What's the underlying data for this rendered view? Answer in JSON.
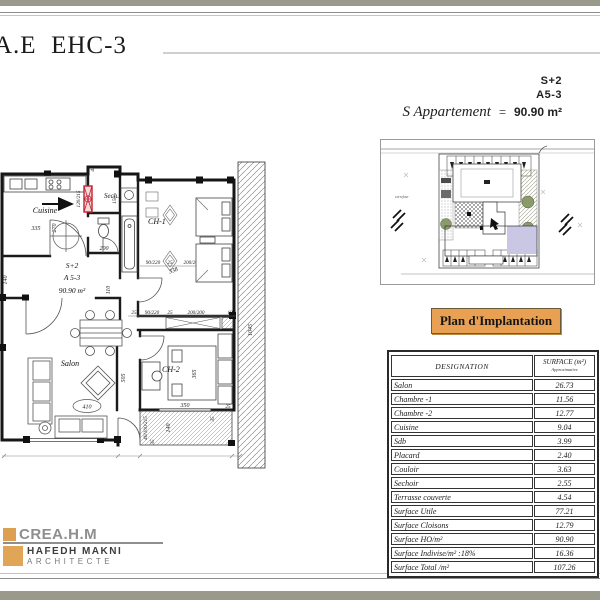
{
  "page": {
    "title": "A.E  EHC-3"
  },
  "unit": {
    "type": "S+2",
    "code": "A5-3",
    "label": "S  Appartement",
    "equals": "=",
    "area": "90.90 m²"
  },
  "siteplan": {
    "road_label": "carrefour"
  },
  "banner": {
    "text": "Plan d'Implantation"
  },
  "table": {
    "header": {
      "designation": "DESIGNATION",
      "surface": "SURFACE (m²)",
      "surface_sub": "Approximative"
    },
    "rows": [
      {
        "label": "Salon",
        "value": "26.73"
      },
      {
        "label": "Chambre -1",
        "value": "11.56"
      },
      {
        "label": "Chambre -2",
        "value": "12.77"
      },
      {
        "label": "Cuisine",
        "value": "9.04"
      },
      {
        "label": "Sdb",
        "value": "3.99"
      },
      {
        "label": "Placard",
        "value": "2.40"
      },
      {
        "label": "Couloir",
        "value": "3.63"
      },
      {
        "label": "Sechoir",
        "value": "2.55"
      },
      {
        "label": "Terrasse couverte",
        "value": "4.54"
      },
      {
        "label": "Surface Utile",
        "value": "77.21"
      },
      {
        "label": "Surface Cloisons",
        "value": "12.79"
      },
      {
        "label": "Surface HO/m²",
        "value": "90.90"
      },
      {
        "label": "Surface Indivise/m² :18%",
        "value": "16.36"
      },
      {
        "label": "Surface Total /m²",
        "value": "107.26"
      }
    ]
  },
  "logo": {
    "brand": "CREA.H.M",
    "name": "HAFEDH MAKNI",
    "title": "ARCHITECTE"
  },
  "plan": {
    "rooms": {
      "cuisine": "Cuisine",
      "sech": "Sech.",
      "ch1": "CH-1",
      "ch2": "CH-2",
      "salon": "Salon"
    },
    "unit": {
      "line1": "S+2",
      "line2": "A 5-3",
      "line3": "90.90 m²"
    },
    "dims": {
      "d45": "45",
      "d150": "150",
      "d120_215": "120/215",
      "d335": "335",
      "d270": "270",
      "d200a": "200",
      "d110": "110",
      "d140l": "140",
      "dstrA1": "90/220",
      "dstrA2": "25",
      "dstrA3": "200/200",
      "dstrB0": "25",
      "dstrB1": "90/220",
      "dstrB2": "25",
      "dstrB3": "200/200",
      "dstrB4": "10",
      "d338": "338",
      "d365": "365",
      "d350": "350",
      "d25e": "25",
      "d410": "410",
      "d505": "505",
      "d1045": "1045",
      "d40_100_215": "40/100/215",
      "d140t": "140",
      "d35a": "35",
      "d35b": "35"
    }
  }
}
